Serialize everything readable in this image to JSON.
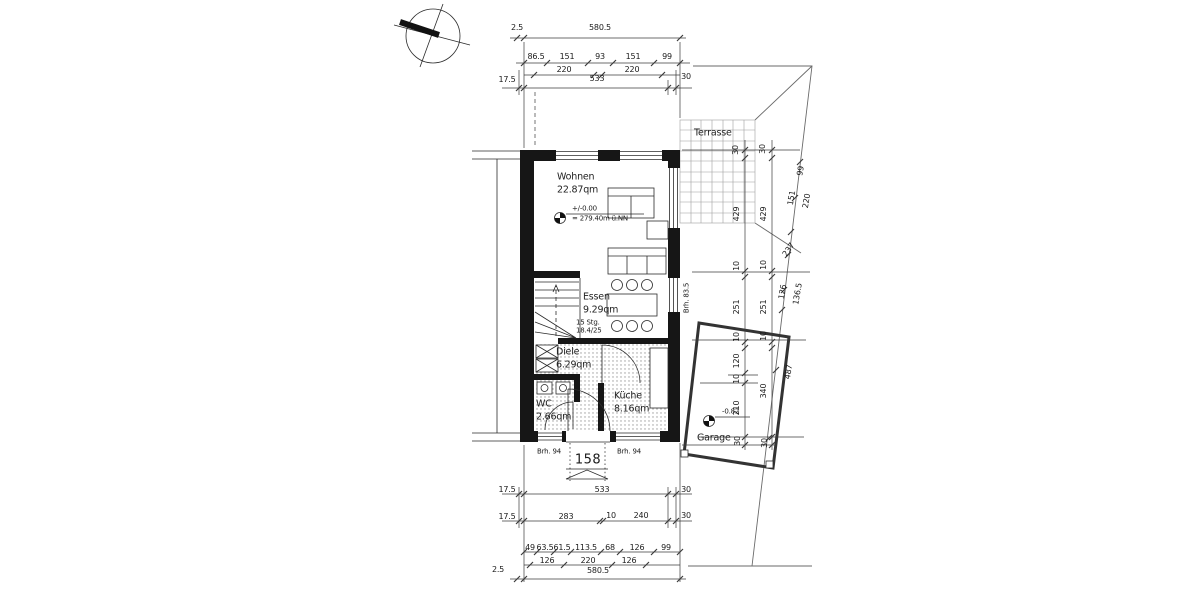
{
  "colors": {
    "paper": "#ffffff",
    "line": "#2b2b2b",
    "dim": "#3c3c3c",
    "grid": "#9e9e9e",
    "wall": "#161616"
  },
  "labels": {
    "dims_top": [
      {
        "text": "2.5",
        "x": 517,
        "y": 28
      },
      {
        "text": "580.5",
        "x": 600,
        "y": 28
      },
      {
        "text": "86.5",
        "x": 536,
        "y": 57
      },
      {
        "text": "151",
        "x": 567,
        "y": 57
      },
      {
        "text": "93",
        "x": 600,
        "y": 57
      },
      {
        "text": "151",
        "x": 633,
        "y": 57
      },
      {
        "text": "99",
        "x": 667,
        "y": 57
      },
      {
        "text": "220",
        "x": 564,
        "y": 70
      },
      {
        "text": "220",
        "x": 632,
        "y": 70
      },
      {
        "text": "17.5",
        "x": 507,
        "y": 80
      },
      {
        "text": "533",
        "x": 597,
        "y": 79
      },
      {
        "text": "30",
        "x": 686,
        "y": 77
      }
    ],
    "dims_bottom": [
      {
        "text": "17.5",
        "x": 507,
        "y": 490
      },
      {
        "text": "533",
        "x": 602,
        "y": 490
      },
      {
        "text": "30",
        "x": 686,
        "y": 490
      },
      {
        "text": "17.5",
        "x": 507,
        "y": 517
      },
      {
        "text": "283",
        "x": 566,
        "y": 517
      },
      {
        "text": "10",
        "x": 611,
        "y": 516
      },
      {
        "text": "240",
        "x": 641,
        "y": 516
      },
      {
        "text": "30",
        "x": 686,
        "y": 516
      },
      {
        "text": "49",
        "x": 530,
        "y": 548
      },
      {
        "text": "63.5",
        "x": 545,
        "y": 548
      },
      {
        "text": "61.5",
        "x": 562,
        "y": 548
      },
      {
        "text": "113.5",
        "x": 586,
        "y": 548
      },
      {
        "text": "68",
        "x": 610,
        "y": 548
      },
      {
        "text": "126",
        "x": 637,
        "y": 548
      },
      {
        "text": "99",
        "x": 666,
        "y": 548
      },
      {
        "text": "126",
        "x": 547,
        "y": 561
      },
      {
        "text": "220",
        "x": 588,
        "y": 561
      },
      {
        "text": "126",
        "x": 629,
        "y": 561
      },
      {
        "text": "2.5",
        "x": 498,
        "y": 570
      },
      {
        "text": "580.5",
        "x": 598,
        "y": 571
      }
    ],
    "dims_right": [
      {
        "text": "30",
        "x": 736,
        "y": 150,
        "rot": -90
      },
      {
        "text": "30",
        "x": 763,
        "y": 149,
        "rot": -90
      },
      {
        "text": "429",
        "x": 737,
        "y": 214,
        "rot": -90
      },
      {
        "text": "429",
        "x": 764,
        "y": 214,
        "rot": -90
      },
      {
        "text": "99",
        "x": 801,
        "y": 171,
        "rot": -80
      },
      {
        "text": "151",
        "x": 792,
        "y": 198,
        "rot": -80
      },
      {
        "text": "220",
        "x": 807,
        "y": 201,
        "rot": -80
      },
      {
        "text": "237",
        "x": 789,
        "y": 250,
        "rot": -55
      },
      {
        "text": "10",
        "x": 737,
        "y": 266,
        "rot": -90
      },
      {
        "text": "10",
        "x": 764,
        "y": 265,
        "rot": -90
      },
      {
        "text": "251",
        "x": 737,
        "y": 307,
        "rot": -90
      },
      {
        "text": "251",
        "x": 764,
        "y": 307,
        "rot": -90
      },
      {
        "text": "126",
        "x": 783,
        "y": 292,
        "rot": -80
      },
      {
        "text": "136.5",
        "x": 798,
        "y": 294,
        "rot": -80
      },
      {
        "text": "10",
        "x": 737,
        "y": 337,
        "rot": -90
      },
      {
        "text": "10",
        "x": 764,
        "y": 336,
        "rot": -90
      },
      {
        "text": "120",
        "x": 737,
        "y": 361,
        "rot": -90
      },
      {
        "text": "10",
        "x": 737,
        "y": 379,
        "rot": -90
      },
      {
        "text": "340",
        "x": 764,
        "y": 391,
        "rot": -90
      },
      {
        "text": "210",
        "x": 737,
        "y": 408,
        "rot": -90
      },
      {
        "text": "487",
        "x": 789,
        "y": 372,
        "rot": -80
      },
      {
        "text": "30",
        "x": 738,
        "y": 441,
        "rot": -90
      },
      {
        "text": "30",
        "x": 765,
        "y": 443,
        "rot": -90
      }
    ],
    "rooms": [
      {
        "name": "room-label-wohnen",
        "text": "Wohnen",
        "x": 557,
        "y": 177,
        "align": "left",
        "cls": "room"
      },
      {
        "name": "room-area-wohnen",
        "text": "22.87qm",
        "x": 557,
        "y": 190,
        "align": "left",
        "cls": "room"
      },
      {
        "name": "room-label-essen",
        "text": "Essen",
        "x": 583,
        "y": 297,
        "align": "left",
        "cls": "room"
      },
      {
        "name": "room-area-essen",
        "text": "9.29qm",
        "x": 583,
        "y": 310,
        "align": "left",
        "cls": "room"
      },
      {
        "name": "room-label-diele",
        "text": "Diele",
        "x": 556,
        "y": 352,
        "align": "left",
        "cls": "room"
      },
      {
        "name": "room-area-diele",
        "text": "6.29qm",
        "x": 556,
        "y": 365,
        "align": "left",
        "cls": "room"
      },
      {
        "name": "room-label-wc",
        "text": "WC",
        "x": 536,
        "y": 404,
        "align": "left",
        "cls": "room"
      },
      {
        "name": "room-area-wc",
        "text": "2.66qm",
        "x": 536,
        "y": 417,
        "align": "left",
        "cls": "room"
      },
      {
        "name": "room-label-kueche",
        "text": "Küche",
        "x": 614,
        "y": 396,
        "align": "left",
        "cls": "room"
      },
      {
        "name": "room-area-kueche",
        "text": "8.16qm",
        "x": 614,
        "y": 409,
        "align": "left",
        "cls": "room"
      },
      {
        "name": "room-label-terrasse",
        "text": "Terrasse",
        "x": 694,
        "y": 133,
        "align": "left",
        "cls": "room"
      },
      {
        "name": "room-label-garage",
        "text": "Garage",
        "x": 697,
        "y": 438,
        "align": "left",
        "cls": "room"
      }
    ],
    "annotations": [
      {
        "name": "stairs-note-1",
        "text": "15 Stg.",
        "x": 576,
        "y": 323,
        "align": "left",
        "cls": "small"
      },
      {
        "name": "stairs-note-2",
        "text": "18.4/25",
        "x": 576,
        "y": 331,
        "align": "left",
        "cls": "small"
      },
      {
        "name": "level-main-value",
        "text": "+/-0.00",
        "x": 572,
        "y": 209,
        "align": "left",
        "cls": "small"
      },
      {
        "name": "level-main-datum",
        "text": "= 279.40m ü.NN",
        "x": 572,
        "y": 219,
        "align": "left",
        "cls": "small"
      },
      {
        "name": "level-garage-value",
        "text": "-0.82",
        "x": 722,
        "y": 412,
        "align": "left",
        "cls": "small"
      },
      {
        "name": "entrance-width",
        "text": "158",
        "x": 588,
        "y": 460,
        "cls": "big"
      },
      {
        "name": "parapet-left",
        "text": "Brh. 94",
        "x": 549,
        "y": 452,
        "cls": "small"
      },
      {
        "name": "parapet-right",
        "text": "Brh. 94",
        "x": 629,
        "y": 452,
        "cls": "small"
      },
      {
        "name": "parapet-side",
        "text": "Brh. 83.5",
        "x": 687,
        "y": 298,
        "rot": -90,
        "cls": "small"
      }
    ]
  }
}
